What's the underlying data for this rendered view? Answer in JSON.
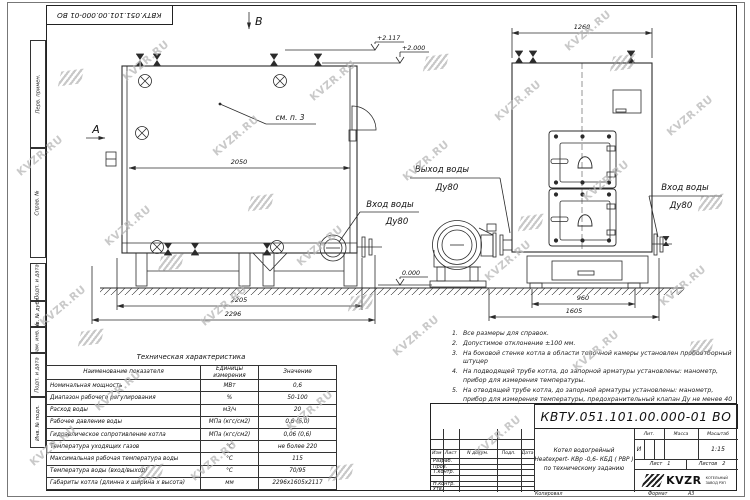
{
  "watermark": {
    "text": "KVZR.RU"
  },
  "side_stamps": [
    "Перв. примен.",
    "Справ. №",
    "Подп. и дата",
    "Инв. № дубл.",
    "Взам. инв. №",
    "Подп. и дата",
    "Инв. № подл."
  ],
  "drawing": {
    "markers": {
      "a": "А",
      "b": "В"
    },
    "see_note": "см. п. 3",
    "labels": {
      "outlet_line1": "Выход воды",
      "outlet_line2": "Ду80",
      "inlet_left_line1": "Вход воды",
      "inlet_left_line2": "Ду80",
      "inlet_right_line1": "Вход воды",
      "inlet_right_line2": "Ду80"
    },
    "elevations": {
      "top": "+2.117",
      "top2": "+2.000",
      "ground": "0.000"
    },
    "dims": {
      "d2050": "2050",
      "d2205": "2205",
      "d2296": "2296",
      "d1260": "1260",
      "d960": "960",
      "d1605": "1605"
    }
  },
  "notes": {
    "items": [
      {
        "num": "1.",
        "text": "Все размеры для справок."
      },
      {
        "num": "2.",
        "text": "Допустимое отклонение  ±100 мм."
      },
      {
        "num": "3.",
        "text": "На боковой стенке котла в области топочной камеры установлен пробоотборный штуцер"
      },
      {
        "num": "4.",
        "text": "На  подводящей трубе котла, до запорной арматуры установлены:  манометр, прибор для измерения температуры."
      },
      {
        "num": "5.",
        "text": "На отводящей трубе котла, до запорной арматуры установлены: манометр, прибор для измерения температуры, предохранительный клапан  Ду не менее  40 мм и обвод с обратным клапаном  Ду не менее  50 мм."
      }
    ]
  },
  "tech_table": {
    "title": "Техническая характеристика",
    "headers": {
      "name": "Наименование показателя",
      "units": "Единицы измерения",
      "value": "Значение"
    },
    "rows": [
      {
        "name": "Номинальная мощность",
        "units": "МВт",
        "value": "0,6"
      },
      {
        "name": "Диапазон рабочего регулирования",
        "units": "%",
        "value": "50-100"
      },
      {
        "name": "Расход воды",
        "units": "м3/ч",
        "value": "20"
      },
      {
        "name": "Рабочее давление воды",
        "units": "МПа (кгс/см2)",
        "value": "0,6 (6,0)"
      },
      {
        "name": "Гидравлическое сопротивление котла",
        "units": "МПа (кгс/см2)",
        "value": "0,06 (0,6)"
      },
      {
        "name": "Температура уходящих газов",
        "units": "°С",
        "value": "не более 220"
      },
      {
        "name": "Максимальная рабочая температура воды",
        "units": "°С",
        "value": "115"
      },
      {
        "name": "Температура воды (вход/выход)",
        "units": "°С",
        "value": "70/95"
      },
      {
        "name": "Габариты котла (длинна х ширина х высота)",
        "units": "мм",
        "value": "2296х1605х2117"
      }
    ]
  },
  "title_block": {
    "doc_number": "КВТУ.051.101.00.000-01  ВО",
    "header_cols": {
      "izm": "Изм",
      "list": "Лист",
      "doc": "N докум.",
      "sign": "Подп.",
      "date": "Дата"
    },
    "row_labels": {
      "r1": "Разраб.",
      "r2": "Пров.",
      "r3": "Т.контр.",
      "r4": "",
      "r5": "Н.контр.",
      "r6": "Утв."
    },
    "name_line1": "Котел водогрейный",
    "name_line2": "Heatexpert- КВр -0,6- КБД ( РВР )",
    "name_line3": "по техническому заданию",
    "lit_header": "Лит.",
    "mass_header": "Масса",
    "scale_header": "Масштаб",
    "lit_value": "И",
    "scale_value": "1:15",
    "sheet_label": "Лист",
    "sheet_value": "1",
    "sheets_label": "Листов",
    "sheets_value": "2",
    "company": {
      "logo_text": "KVZR",
      "line1": "КОТЕЛЬНЫЙ",
      "line2": "ЗАВОД РЭП"
    }
  },
  "footer": {
    "copied": "Копировал",
    "format_label": "Формат",
    "format_value": "А3"
  }
}
